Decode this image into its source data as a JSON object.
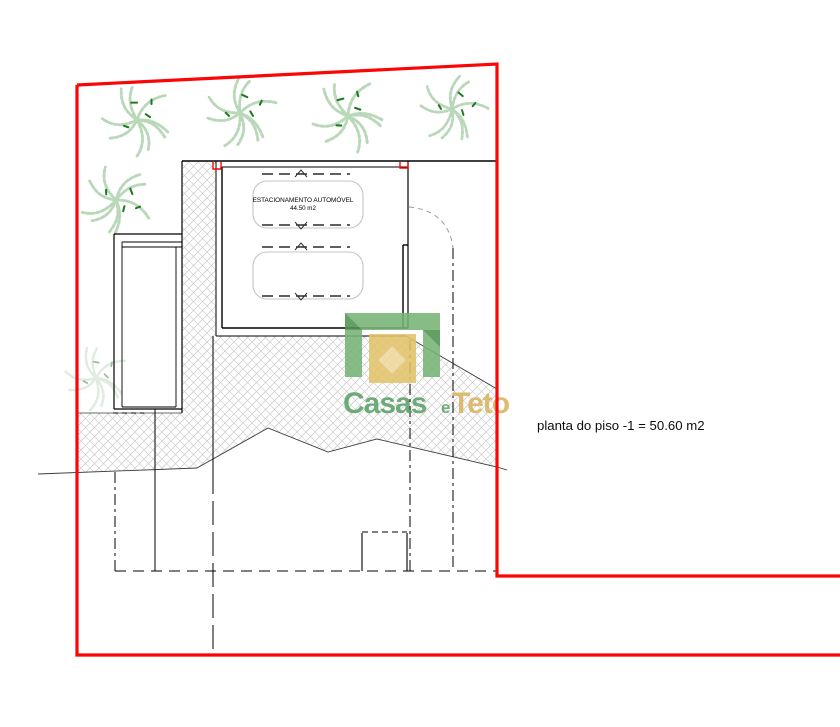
{
  "drawing": {
    "type": "architectural-site-plan",
    "garage": {
      "label_line1": "ESTACIONAMENTO AUTOMÓVEL",
      "label_line2": "44.50 m2"
    },
    "caption": "planta do piso -1 = 50.60 m2",
    "watermark": {
      "word1": "Casas",
      "word2": "e",
      "word3": "Teto"
    },
    "colors": {
      "boundary_red": "#fb0505",
      "wall_black": "#000000",
      "hatch_gray": "#c9c9c9",
      "terrain_line": "#3a3a3a",
      "car_outline": "#c4c4c4",
      "driveway_arc": "#9a9a9a",
      "logo_green": "#77b377",
      "logo_green_dark": "#4f934f",
      "logo_gold": "#e2c36b",
      "logo_gold_light": "#f0dca6",
      "logo_text_green": "#5ca16a",
      "logo_text_gold": "#d9b45f",
      "tree_green": "#b9d7b9",
      "tree_dark_green": "#1d7a1d"
    }
  }
}
